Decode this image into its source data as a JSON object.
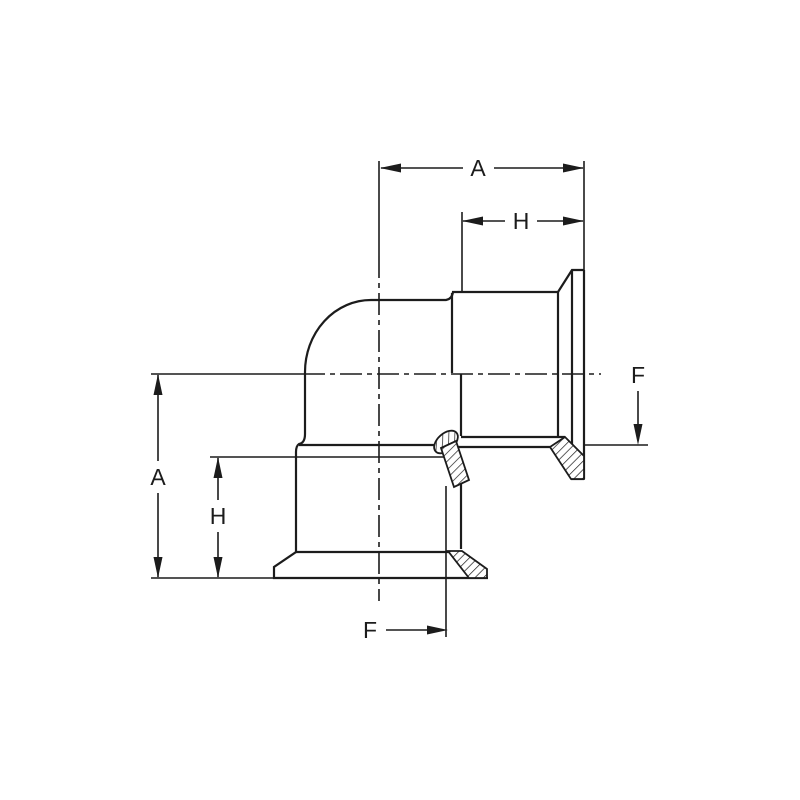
{
  "drawing": {
    "description": "Orthographic dimensioned drawing of a 90-degree elbow pipe fitting with clamp ferrule ends, partial section with hatching",
    "background_color": "#ffffff",
    "line_color": "#1c1c1c",
    "labels": {
      "dim_a_top": "A",
      "dim_h_top": "H",
      "dim_a_left": "A",
      "dim_h_left": "H",
      "dim_f_right": "F",
      "dim_f_bottom": "F"
    },
    "dimensions": [
      {
        "label": "A",
        "orientation": "horizontal",
        "location": "top",
        "measures": "centerline to right flange face"
      },
      {
        "label": "H",
        "orientation": "horizontal",
        "location": "top",
        "measures": "ferrule length to right flange face"
      },
      {
        "label": "A",
        "orientation": "vertical",
        "location": "left",
        "measures": "centerline to bottom flange face"
      },
      {
        "label": "H",
        "orientation": "vertical",
        "location": "left",
        "measures": "ferrule length to bottom flange face"
      },
      {
        "label": "F",
        "orientation": "leader-down",
        "location": "right",
        "measures": "bore line of right outlet"
      },
      {
        "label": "F",
        "orientation": "leader-right",
        "location": "bottom",
        "measures": "bore line of bottom outlet"
      }
    ]
  }
}
